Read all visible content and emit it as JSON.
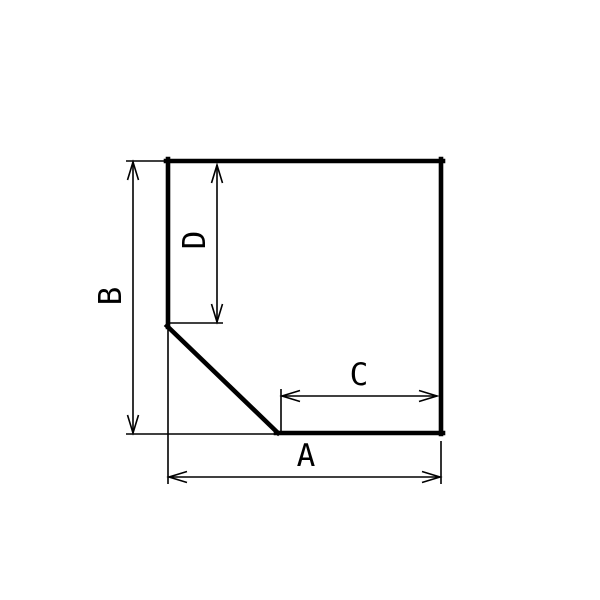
{
  "drawing": {
    "description": "Technical dimension drawing of a square profile with a chamfered bottom-left corner",
    "labels": {
      "a": "A",
      "b": "B",
      "c": "C",
      "d": "D"
    },
    "colors": {
      "line": "#000000",
      "background": "#ffffff"
    }
  }
}
